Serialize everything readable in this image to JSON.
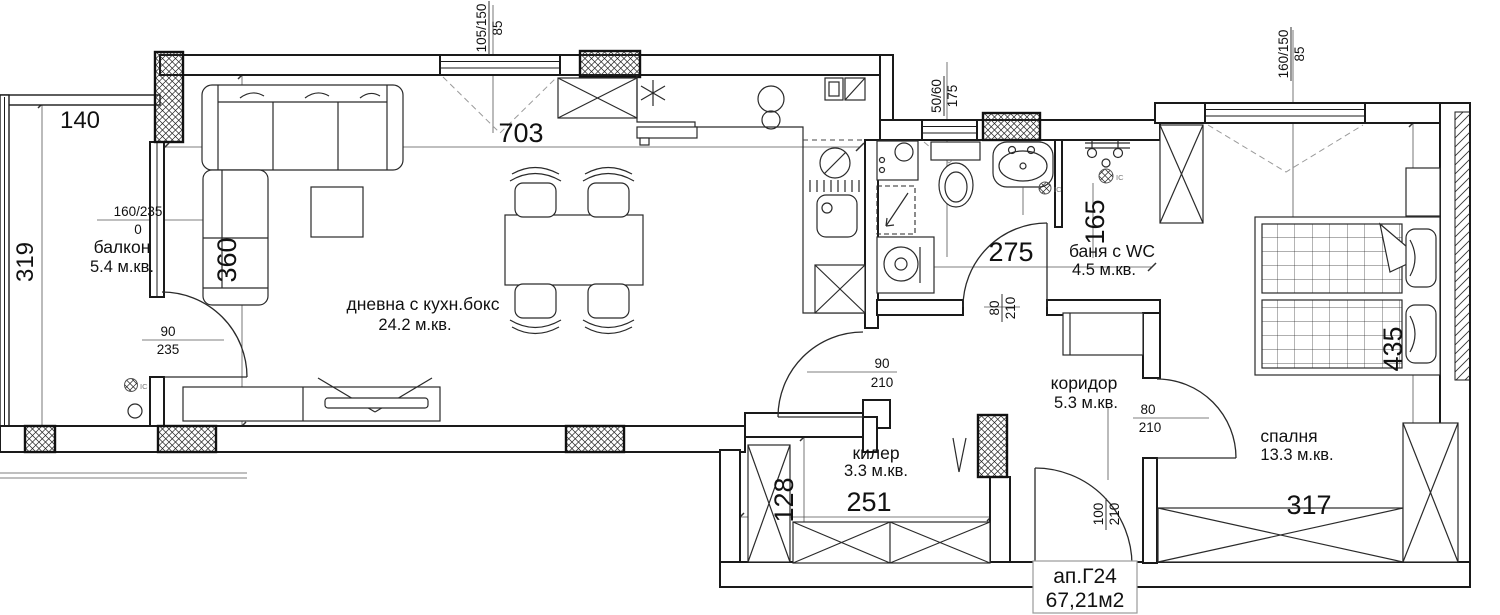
{
  "apartment": {
    "id": "ап.Г24",
    "total_area": "67,21м2"
  },
  "rooms": {
    "balcony": {
      "name": "балкон",
      "area": "5.4 м.кв."
    },
    "living": {
      "name": "дневна с кухн.бокс",
      "area": "24.2 м.кв."
    },
    "closet": {
      "name": "килер",
      "area": "3.3 м.кв."
    },
    "bath": {
      "name": "баня с WC",
      "area": "4.5 м.кв."
    },
    "corridor": {
      "name": "коридор",
      "area": "5.3 м.кв."
    },
    "bedroom": {
      "name": "спалня",
      "area": "13.3 м.кв."
    }
  },
  "dims": {
    "balcony_w": "140",
    "balcony_h": "319",
    "living_w": "703",
    "living_h": "360",
    "closet_w": "251",
    "closet_h": "128",
    "bath_w": "275",
    "bath_niche": "165",
    "bedroom_w": "317",
    "bedroom_h": "435"
  },
  "openings": {
    "balcony_window": {
      "size": "160/235",
      "sill": "0"
    },
    "living_window": {
      "size": "105/150",
      "sill": "85"
    },
    "bath_window": {
      "size": "50/60",
      "sill": "175"
    },
    "bedroom_window": {
      "size": "160/150",
      "sill": "85"
    },
    "balcony_door": {
      "w": "90",
      "h": "235"
    },
    "hall_door": {
      "w": "90",
      "h": "210"
    },
    "bath_door": {
      "w": "80",
      "h": "210"
    },
    "bedroom_door": {
      "w": "80",
      "h": "210"
    },
    "entry_door": {
      "w": "100",
      "h": "210"
    }
  },
  "symbols": {
    "outlet_label": "IC"
  }
}
